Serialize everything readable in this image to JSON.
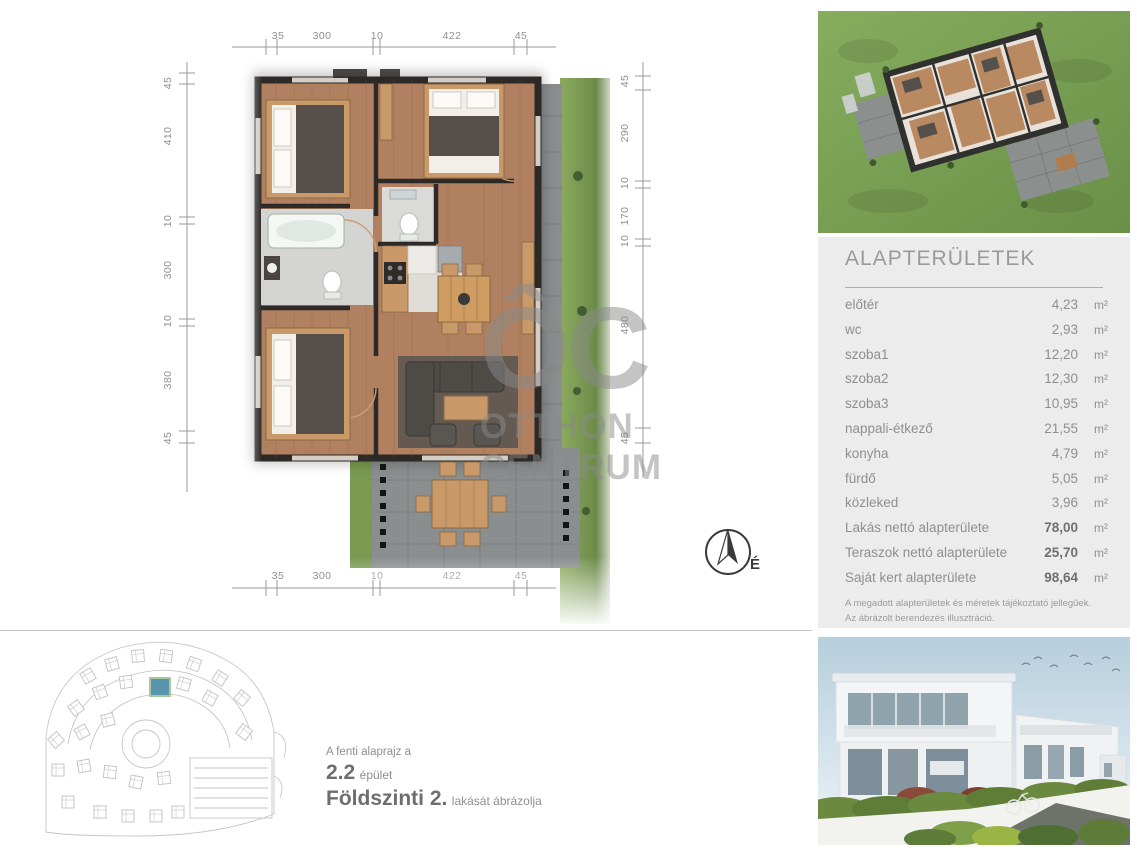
{
  "dims": {
    "top": [
      "35",
      "300",
      "10",
      "422",
      "45"
    ],
    "bottom": [
      "35",
      "300",
      "10",
      "422",
      "45"
    ],
    "left": [
      "45",
      "410",
      "10",
      "300",
      "10",
      "380",
      "45"
    ],
    "right": [
      "45",
      "290",
      "10",
      "170",
      "10",
      "480",
      "45"
    ]
  },
  "watermark": {
    "monogram": "ÔC",
    "line1": "OTTHON",
    "line2": "CENTRUM"
  },
  "compass": {
    "label": "É"
  },
  "caption": {
    "intro": "A fenti alaprajz a",
    "building_number": "2.2",
    "building_word": "épület",
    "floor": "Földszinti 2.",
    "floor_suffix": "lakását ábrázolja"
  },
  "areas": {
    "title": "ALAPTERÜLETEK",
    "rows": [
      {
        "label": "előtér",
        "value": "4,23",
        "unit": "m²"
      },
      {
        "label": "wc",
        "value": "2,93",
        "unit": "m²"
      },
      {
        "label": "szoba1",
        "value": "12,20",
        "unit": "m²"
      },
      {
        "label": "szoba2",
        "value": "12,30",
        "unit": "m²"
      },
      {
        "label": "szoba3",
        "value": "10,95",
        "unit": "m²"
      },
      {
        "label": "nappali-étkező",
        "value": "21,55",
        "unit": "m²"
      },
      {
        "label": "konyha",
        "value": "4,79",
        "unit": "m²"
      },
      {
        "label": "fürdő",
        "value": "5,05",
        "unit": "m²"
      },
      {
        "label": "közleked",
        "value": "3,96",
        "unit": "m²"
      },
      {
        "label": "Lakás nettó alapterülete",
        "value": "78,00",
        "unit": "m²"
      },
      {
        "label": "Teraszok nettó alapterülete",
        "value": "25,70",
        "unit": "m²"
      },
      {
        "label": "Saját kert alapterülete",
        "value": "98,64",
        "unit": "m²"
      }
    ],
    "notes": [
      "A megadott alapterületek és méretek tájékoztató jellegűek.",
      "Az ábrázolt berendezés illusztráció."
    ]
  },
  "colors": {
    "panel_bg": "#ececec",
    "text_gray": "#8f8f8f",
    "dim_gray": "#9a9a9a",
    "wood": "#b08060",
    "wall": "#2c2926",
    "grass": "#7da356",
    "highlight_teal": "#5794ad"
  }
}
